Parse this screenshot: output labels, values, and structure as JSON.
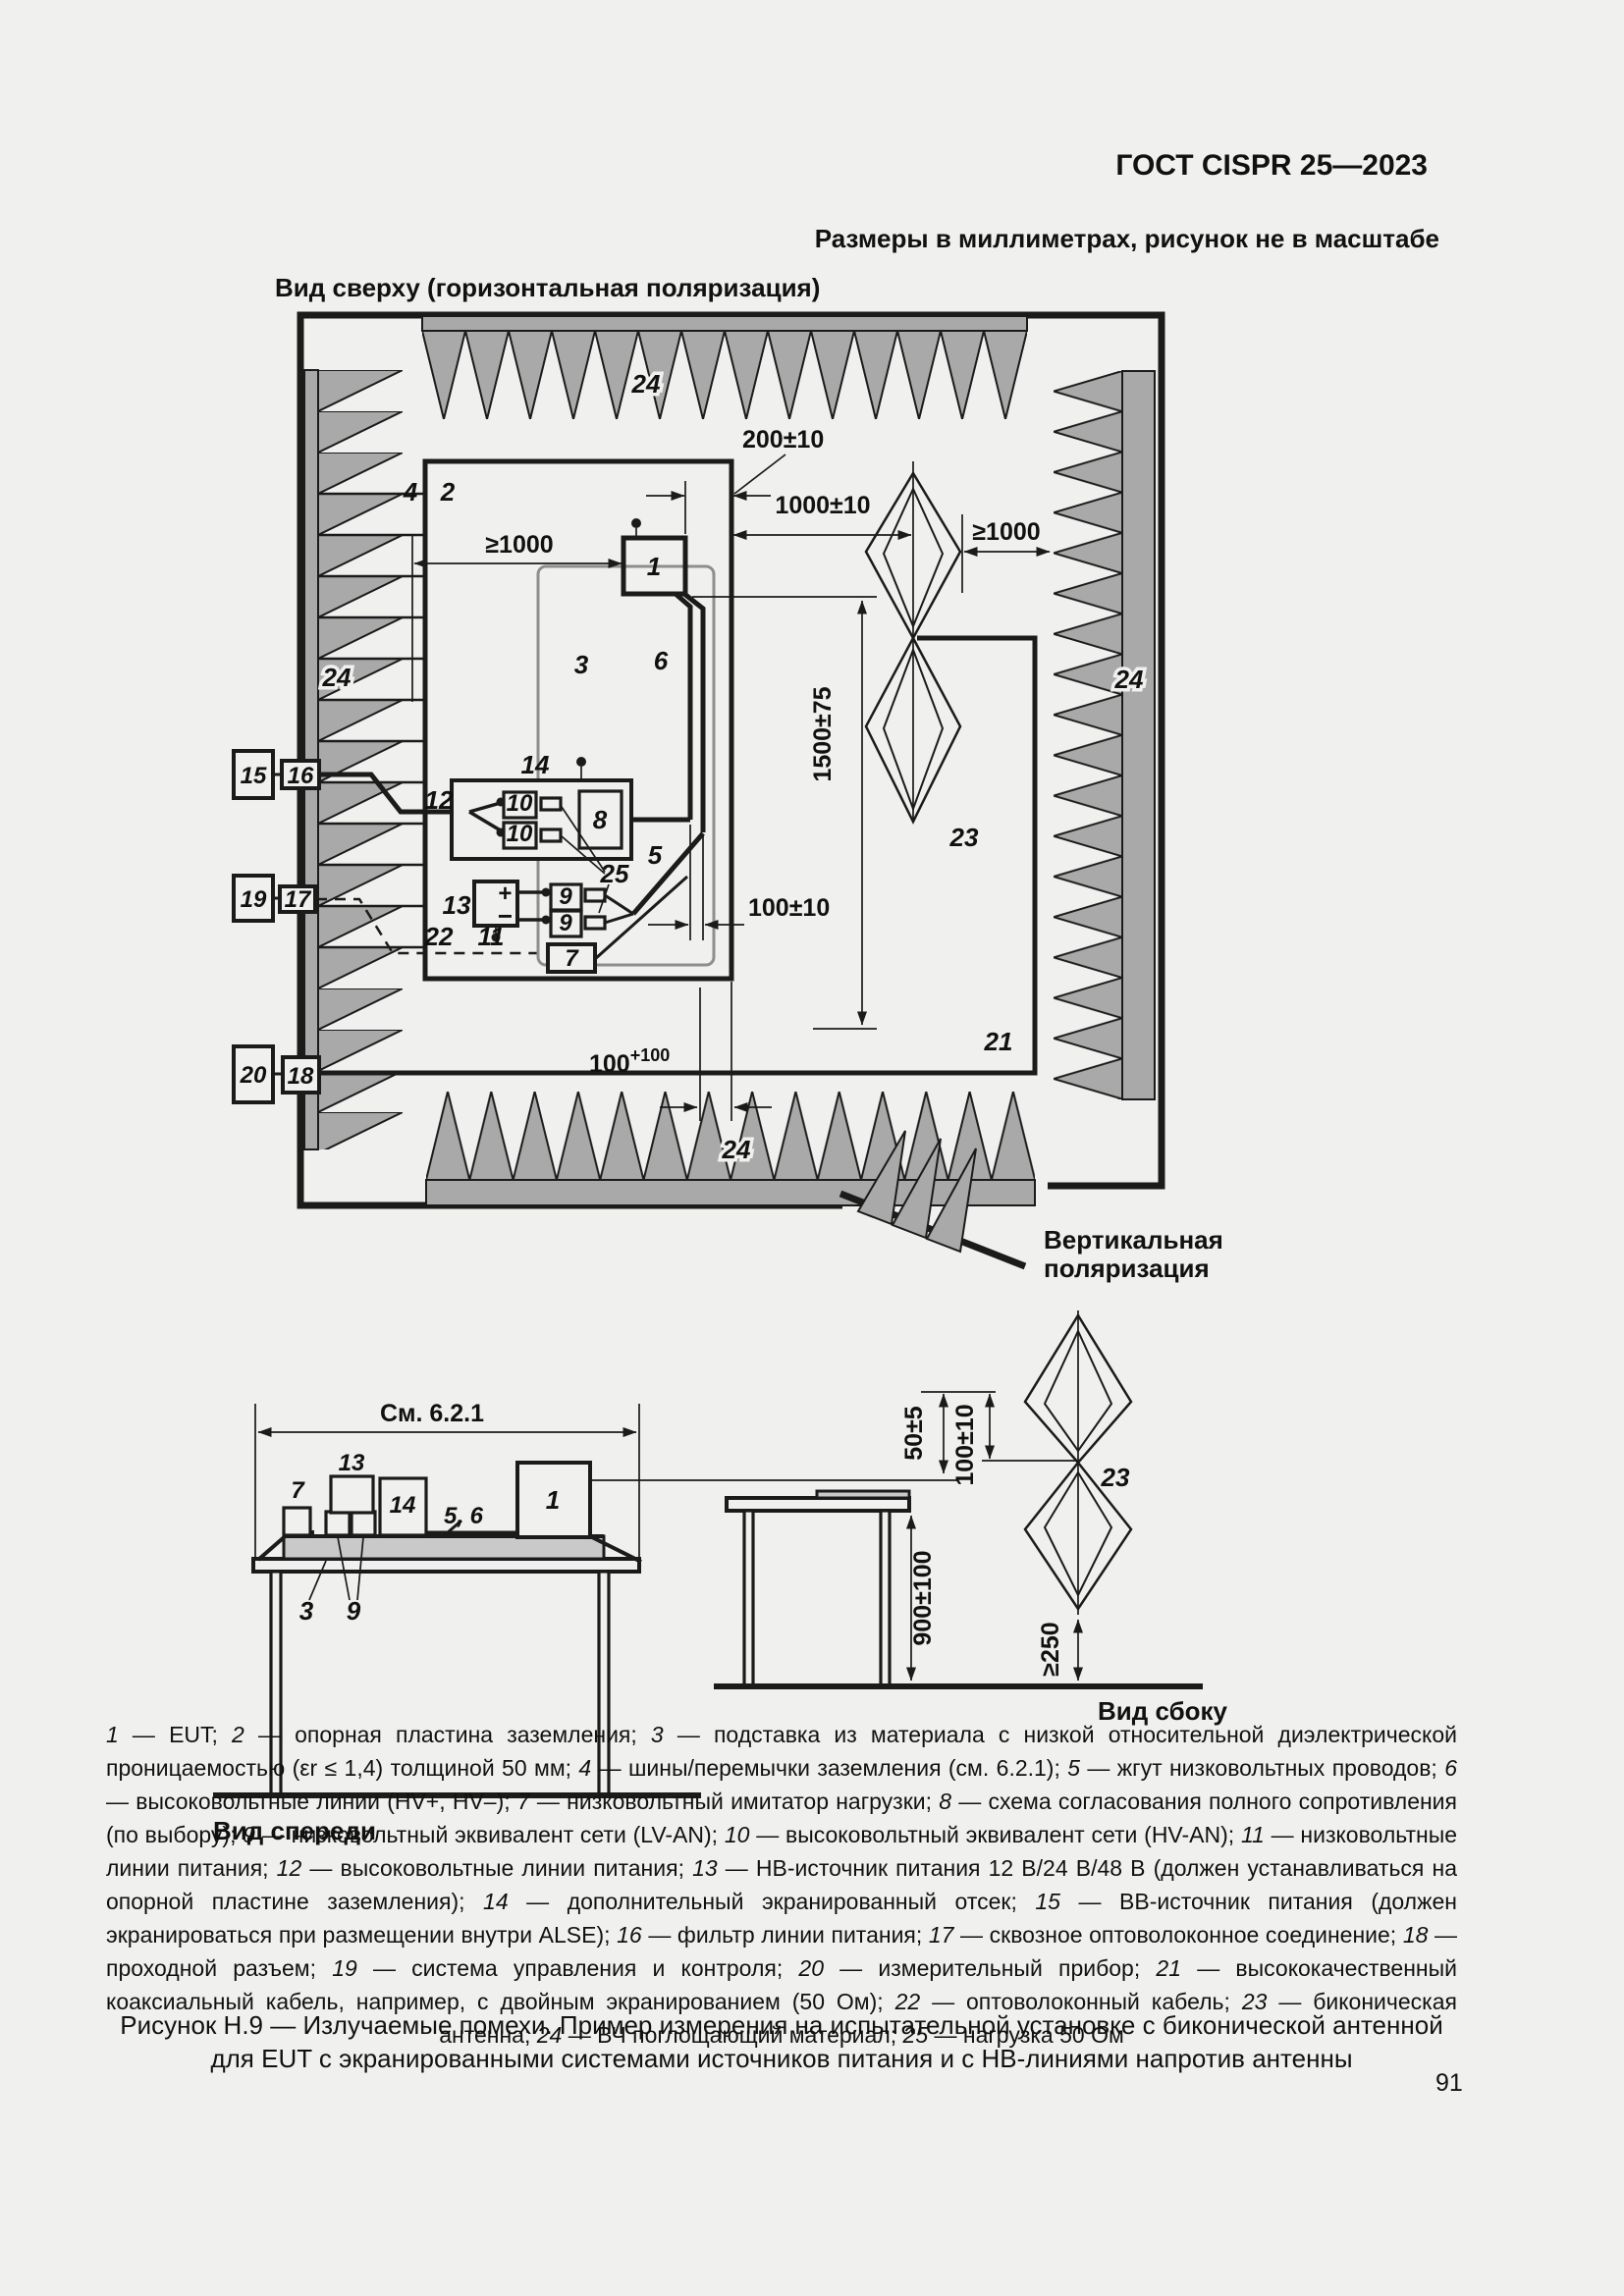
{
  "page": {
    "header": "ГОСТ CISPR 25—2023",
    "units_note": "Размеры в миллиметрах, рисунок не в масштабе",
    "page_number": "91"
  },
  "top_view": {
    "title": "Вид сверху (горизонтальная поляризация)",
    "vpol_line1": "Вертикальная",
    "vpol_line2": "поляризация",
    "dims": {
      "d200": "200±10",
      "d1000": "1000±10",
      "ge1000_left": "≥1000",
      "ge1000_right": "≥1000",
      "d1500": "1500±75",
      "d100": "100±10",
      "d100_base": "100",
      "d100_sup": "+100"
    },
    "labels": {
      "n1": "1",
      "n2": "2",
      "n3": "3",
      "n4": "4",
      "n5": "5",
      "n6": "6",
      "n7": "7",
      "n8": "8",
      "n9a": "9",
      "n9b": "9",
      "n10a": "10",
      "n10b": "10",
      "n11": "11",
      "n12": "12",
      "n13": "13",
      "n14": "14",
      "n15": "15",
      "n16": "16",
      "n17": "17",
      "n18": "18",
      "n19": "19",
      "n20": "20",
      "n21": "21",
      "n22": "22",
      "n23": "23",
      "n24_top": "24",
      "n24_left": "24",
      "n24_right": "24",
      "n24_bottom": "24",
      "n25": "25",
      "plus": "+",
      "minus": "−"
    }
  },
  "front_view": {
    "title": "Вид спереди",
    "see_ref": "См. 6.2.1",
    "labels": {
      "n1": "1",
      "n3": "3",
      "n7": "7",
      "n9": "9",
      "n13": "13",
      "n14": "14",
      "n56": "5, 6"
    }
  },
  "side_view": {
    "title": "Вид сбоку",
    "label_23": "23",
    "dims": {
      "d50": "50±5",
      "d100": "100±10",
      "d900": "900±100",
      "d250": "≥250"
    }
  },
  "legend": {
    "dash": " — ",
    "sep": "; ",
    "items": [
      {
        "n": "1",
        "t": "EUT"
      },
      {
        "n": "2",
        "t": "опорная пластина заземления"
      },
      {
        "n": "3",
        "t": "подставка из материала с низкой относительной диэлектрической проницаемостью (εr ≤ 1,4) толщиной 50 мм"
      },
      {
        "n": "4",
        "t": "шины/перемычки заземления (см. 6.2.1)"
      },
      {
        "n": "5",
        "t": "жгут низковольтных проводов"
      },
      {
        "n": "6",
        "t": "высоковольтные линии (HV+, HV–)"
      },
      {
        "n": "7",
        "t": "низковольтный имитатор нагрузки"
      },
      {
        "n": "8",
        "t": "схема согласования полного сопротивления (по выбору)"
      },
      {
        "n": "9",
        "t": "низковольтный эквивалент сети (LV-AN)"
      },
      {
        "n": "10",
        "t": "высоковольтный эквивалент сети (HV-AN)"
      },
      {
        "n": "11",
        "t": "низковольтные линии питания"
      },
      {
        "n": "12",
        "t": "высоковольтные линии питания"
      },
      {
        "n": "13",
        "t": "НВ-источник питания 12 В/24 В/48 В (должен устанавливаться на опорной пластине заземления)"
      },
      {
        "n": "14",
        "t": "дополнительный экранированный отсек"
      },
      {
        "n": "15",
        "t": "ВВ-источник питания (должен экранироваться при размещении внутри ALSE)"
      },
      {
        "n": "16",
        "t": "фильтр линии питания"
      },
      {
        "n": "17",
        "t": "сквозное оптоволоконное соединение"
      },
      {
        "n": "18",
        "t": "проходной разъем"
      },
      {
        "n": "19",
        "t": "система управления и контроля"
      },
      {
        "n": "20",
        "t": "измерительный прибор"
      },
      {
        "n": "21",
        "t": "высококачественный коаксиальный кабель, например, с двойным экранированием (50 Ом)"
      },
      {
        "n": "22",
        "t": "оптоволоконный кабель"
      },
      {
        "n": "23",
        "t": "биконическая антенна"
      },
      {
        "n": "24",
        "t": "ВЧ поглощающий материал"
      },
      {
        "n": "25",
        "t": "нагрузка 50 Ом"
      }
    ]
  },
  "caption": {
    "line1": "Рисунок Н.9 — Излучаемые помехи. Пример измерения на испытательной установке с биконической антенной",
    "line2": "для EUT с экранированными системами источников питания и с НВ-линиями напротив антенны"
  }
}
